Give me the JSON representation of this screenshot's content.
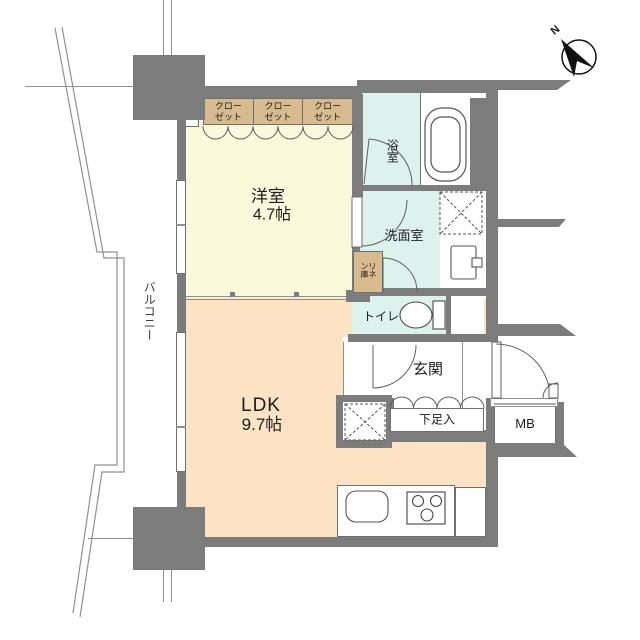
{
  "floorplan": {
    "rooms": {
      "western_room": {
        "name": "洋室",
        "size": "4.7帖"
      },
      "ldk": {
        "name": "LDK",
        "size": "9.7帖"
      },
      "bathroom": {
        "name": "浴室"
      },
      "washroom": {
        "name": "洗面室"
      },
      "toilet": {
        "name": "トイレ"
      },
      "entrance": {
        "name": "玄関"
      },
      "balcony": {
        "name": "バルコニー"
      }
    },
    "closets": [
      {
        "line1": "クロー",
        "line2": "ゼット"
      },
      {
        "line1": "クロー",
        "line2": "ゼット"
      },
      {
        "line1": "クロー",
        "line2": "ゼット"
      }
    ],
    "storage": {
      "linen_closet": "リネン庫",
      "shoe_cabinet": "下足入",
      "meter_box": "MB"
    },
    "appliances": {
      "washer": "洗",
      "refrigerator": "冷"
    },
    "compass": {
      "north": "N"
    },
    "colors": {
      "wall": "#7c7c7c",
      "western_room_floor": "#f8f8da",
      "ldk_floor": "#fbe3c4",
      "wet_area_floor": "#ddf1ed",
      "closet_fill": "#d7ba8e"
    }
  }
}
